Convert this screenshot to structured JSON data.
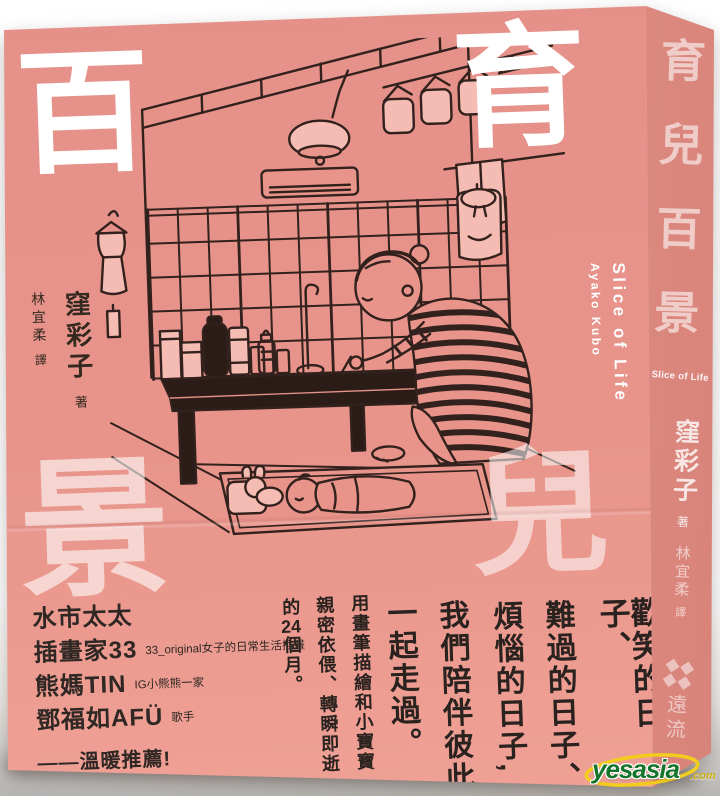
{
  "colors": {
    "cover_pink": "#e8948b",
    "spine_pink": "#dd897f",
    "illustration_line": "#32211c",
    "illustration_fill": "#f4bcb3",
    "title_white": "#ffffff",
    "text_dark": "#2a221f",
    "watermark_green": "#15742b",
    "watermark_yellow": "#f2cd1c"
  },
  "cover": {
    "title_char_top_left": "百",
    "title_char_top_right": "育",
    "title_char_mid_right": "兒",
    "title_char_bottom_left": "景",
    "author": "窪彩子",
    "author_role": "著",
    "translator": "林宜柔",
    "translator_role": "譯",
    "subtitle_en": "Slice of Life",
    "author_en": "Ayako Kubo",
    "tagline_columns": [
      "歡笑的日子、",
      "難過的日子、",
      "煩惱的日子,",
      "我們陪伴彼此",
      "一起走過。",
      "用畫筆描繪和小寶寶",
      "親密依偎、轉瞬即逝",
      "的24個月。"
    ],
    "recommenders": [
      {
        "name": "水市太太",
        "note": ""
      },
      {
        "name": "插畫家33",
        "note": "33_original女子的日常生活插畫"
      },
      {
        "name": "熊媽TIN",
        "note": "IG小熊熊一家"
      },
      {
        "name": "鄧福如AFÜ",
        "note": "歌手"
      }
    ],
    "recommend_line": "——溫暖推薦!"
  },
  "spine": {
    "title_chars": [
      "育",
      "兒",
      "百",
      "景"
    ],
    "subtitle_en": "Slice of Life",
    "author": "窪彩子",
    "author_role": "著",
    "translator": "林宜柔",
    "translator_role": "譯",
    "publisher": "遠流"
  },
  "watermark": {
    "brand": "yesasia",
    "suffix": ".com"
  }
}
